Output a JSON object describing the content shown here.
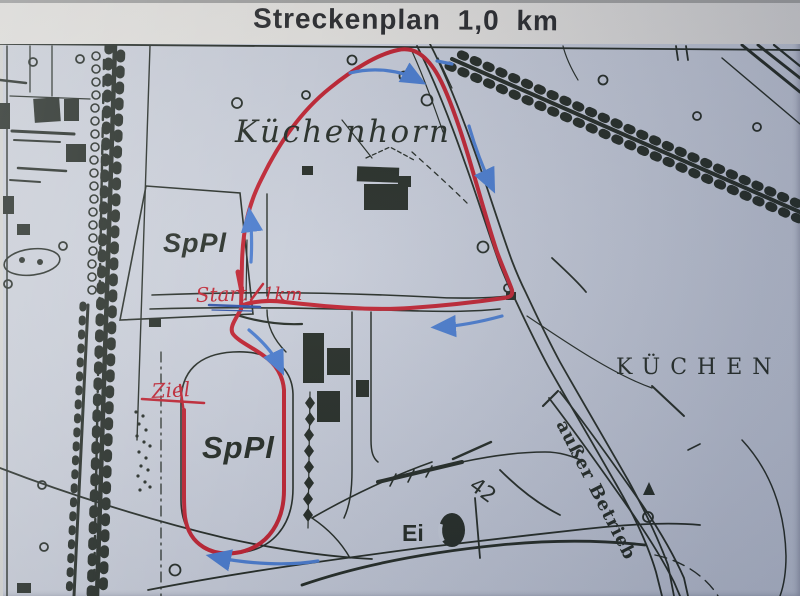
{
  "title": "Streckenplan 1,0 km",
  "map": {
    "place_labels": {
      "kuechenhorn": "Küchenhorn",
      "sppl_upper": "SpPl",
      "sppl_lower": "SpPl",
      "kuechen": "KÜCHEN",
      "ausser_betrieb": "außer Betrieb",
      "ei": "Ei",
      "road_number": "42"
    },
    "route_annotations": {
      "start": "Start",
      "distance": "1km",
      "finish": "Ziel"
    }
  },
  "colors": {
    "route_red": "#c02230",
    "arrow_blue": "#4a7cce",
    "underline_blue": "#2d50a6",
    "map_ink": "#242b24",
    "paper_map": "#c6ccd8",
    "paper_title": "#e8e6e1",
    "title_ink": "#2b2c2e"
  }
}
